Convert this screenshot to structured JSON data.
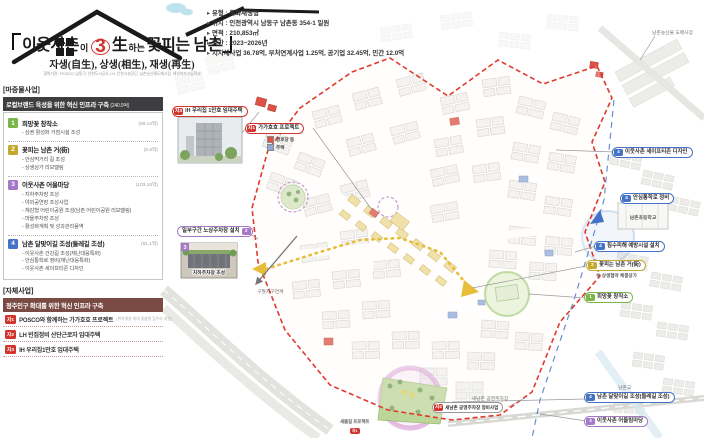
{
  "colors": {
    "green": "#7ab648",
    "yellow": "#c4a92e",
    "purple": "#a678c8",
    "blue": "#4472c4",
    "red": "#d0342c"
  },
  "header": {
    "title": {
      "p1": "이웃사촌",
      "p2": "이",
      "num": "3",
      "p3": "生",
      "p4": "하는",
      "p5": "꽃피는 남촌"
    },
    "subtitle": "자생(自生), 상생(相生), 재생(再生)",
    "partners": "협력기관 : POSCO, 남동구, 인천도시공사, LH, 인천시설공단, 남촌농산물도매시장, 해성여자고등학교"
  },
  "info": {
    "items": [
      "유형 : 특화재생형",
      "위치 : 인천광역시 남동구 남촌동 354-1 일원",
      "면적 : 210,853㎡",
      "기간 : 2023~2026년",
      "지자체사업 36.78억, 부처연계사업 1.25억, 공기업 32.45억, 민간 12.0억"
    ]
  },
  "priming": {
    "bracket_label": "[마중물사업]",
    "header": "로컬브랜드 육성을 위한 혁신 인프라 구축",
    "header_amount": "(240.0억)",
    "items": [
      {
        "num": "1",
        "title": "희망꽃 창작소",
        "amount": "(69.14억)",
        "bullets": [
          "상권 활성화 거점시설 조성"
        ]
      },
      {
        "num": "2",
        "title": "꽃피는 남촌 거(街)",
        "amount": "(6.6억)",
        "bullets": [
          "안심먹거리 길 조성",
          "상생상가 리모델링"
        ]
      },
      {
        "num": "3",
        "title": "이웃사촌 어울마당",
        "amount": "(103.16억)",
        "bullets": [
          "지하주차장 조성",
          "야외공연장 조성사업",
          "체감형 어린이공원 조성(남촌 어린이공원 리모델링)",
          "마을주차장 조성",
          "활성화계획 및 성과관리용역"
        ]
      },
      {
        "num": "4",
        "title": "남촌 달맞이길 조성(둘레길 조성)",
        "amount": "(61.1억)",
        "bullets": [
          "이웃사촌 건강길 조성(재난대응특화)",
          "안심통학로 정비(재난대응특화)",
          "이웃사촌 세이프티존 디자인"
        ]
      }
    ]
  },
  "self_projects": {
    "bracket_label": "[자체사업]",
    "header": "정주인구 확대를 위한 혁신 인프라 구축",
    "items": [
      {
        "badge": "자1",
        "label": "POSCO와 함께하는 가가호호 프로젝트",
        "note": "(취약계층 세대 맞춤형 집수리 지원)"
      },
      {
        "badge": "자2",
        "label": "LH 빈집정비 산단근로자 임대주택",
        "note": ""
      },
      {
        "badge": "자3",
        "label": "IH 우리집1만호 임대주택",
        "note": ""
      }
    ]
  },
  "map": {
    "callouts": {
      "ih_housing": {
        "badge": "자3",
        "label": "IH 우리집 1만호 임대주택"
      },
      "gagahoho": {
        "badge": "자1",
        "label": "가가호호 프로젝트"
      },
      "nosang": {
        "badge": "3",
        "label": "일부구간 노상주차장 설치"
      },
      "underground": {
        "badge": "3",
        "label": "지하주차장 조성"
      },
      "safezone": {
        "badge": "4",
        "label": "이웃사촌 세이프티존 디자인"
      },
      "schoolroad": {
        "badge": "4",
        "label": "안심통학로 정비"
      },
      "flood": {
        "badge": "4",
        "label": "침수피해 예방시설 설치"
      },
      "flower_street": {
        "badge": "2",
        "label": "꽃피는 남촌 거(街)"
      },
      "flower_note": "※ 상생협약 체결상가",
      "hope": {
        "badge": "1",
        "label": "희망꽃 창작소"
      },
      "dalmaji": {
        "badge": "4",
        "label": "남촌 달맞이길 조성(둘레길 조성)"
      },
      "oullim": {
        "badge": "3",
        "label": "이웃사촌 어울림마당"
      },
      "saenamchon": {
        "badge": "자2",
        "label": "새남촌 공영주차장 정비사업"
      },
      "saeddeul": {
        "badge": "자1",
        "label": "새뜰길 프로젝트"
      }
    },
    "legend": {
      "elderly": "경로당 등",
      "housing": "주택"
    },
    "labels": {
      "school": "남촌초등학교",
      "parking": "새남촌 공영주차장",
      "guwol": "구월지구연계",
      "bridge": "남촌교",
      "market": "남촌농산물 도매시장"
    }
  }
}
